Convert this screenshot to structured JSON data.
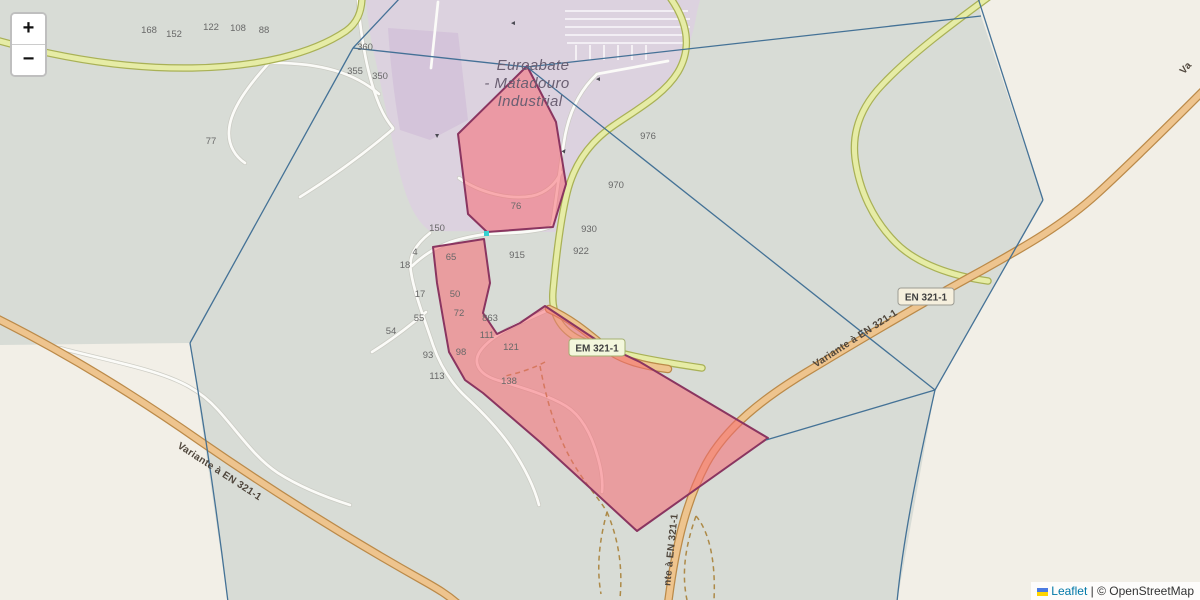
{
  "map": {
    "zoom_control": {
      "zoom_in": "+",
      "zoom_out": "−"
    },
    "attribution": {
      "leaflet": "Leaflet",
      "separator": " | ",
      "copyright": "© OpenStreetMap"
    },
    "place_label": {
      "lines": [
        "Euroabate",
        "- Matadouro",
        "Industrial"
      ]
    },
    "road_badges": [
      {
        "text": "EN 321-1",
        "x": 926,
        "y": 297,
        "style": "primary"
      },
      {
        "text": "EM 321-1",
        "x": 597,
        "y": 348,
        "style": "secondary"
      }
    ],
    "road_name_labels": [
      {
        "text": "Variante à EN 321-1",
        "x": 857,
        "y": 341,
        "rotate": -33
      },
      {
        "text": "Variante à EN 321-1",
        "x": 218,
        "y": 474,
        "rotate": 33
      },
      {
        "text": "nte à EN 321-1",
        "x": 674,
        "y": 550,
        "rotate": -84
      },
      {
        "text": "Va",
        "x": 1188,
        "y": 70,
        "rotate": -48
      }
    ],
    "house_numbers": [
      {
        "t": "168",
        "x": 149,
        "y": 33
      },
      {
        "t": "152",
        "x": 174,
        "y": 37
      },
      {
        "t": "122",
        "x": 211,
        "y": 30
      },
      {
        "t": "108",
        "x": 238,
        "y": 31
      },
      {
        "t": "88",
        "x": 264,
        "y": 33
      },
      {
        "t": "77",
        "x": 211,
        "y": 144
      },
      {
        "t": "360",
        "x": 365,
        "y": 50
      },
      {
        "t": "355",
        "x": 355,
        "y": 74
      },
      {
        "t": "350",
        "x": 380,
        "y": 79
      },
      {
        "t": "150",
        "x": 437,
        "y": 231
      },
      {
        "t": "4",
        "x": 415,
        "y": 255
      },
      {
        "t": "18",
        "x": 405,
        "y": 268
      },
      {
        "t": "65",
        "x": 451,
        "y": 260
      },
      {
        "t": "915",
        "x": 517,
        "y": 258
      },
      {
        "t": "17",
        "x": 420,
        "y": 297
      },
      {
        "t": "50",
        "x": 455,
        "y": 297
      },
      {
        "t": "72",
        "x": 459,
        "y": 316
      },
      {
        "t": "863",
        "x": 490,
        "y": 321
      },
      {
        "t": "55",
        "x": 419,
        "y": 321
      },
      {
        "t": "54",
        "x": 391,
        "y": 334
      },
      {
        "t": "93",
        "x": 428,
        "y": 358
      },
      {
        "t": "98",
        "x": 461,
        "y": 355
      },
      {
        "t": "113",
        "x": 437,
        "y": 379
      },
      {
        "t": "111",
        "x": 487,
        "y": 338
      },
      {
        "t": "121",
        "x": 511,
        "y": 350
      },
      {
        "t": "138",
        "x": 509,
        "y": 384
      },
      {
        "t": "76",
        "x": 516,
        "y": 209
      },
      {
        "t": "976",
        "x": 648,
        "y": 139
      },
      {
        "t": "970",
        "x": 616,
        "y": 188
      },
      {
        "t": "930",
        "x": 589,
        "y": 232
      },
      {
        "t": "922",
        "x": 581,
        "y": 254
      }
    ],
    "oneway_arrows": [
      {
        "x": 598,
        "y": 74,
        "r": 180
      },
      {
        "x": 566,
        "y": 149,
        "r": -55
      },
      {
        "x": 435,
        "y": 133,
        "r": 90
      },
      {
        "x": 513,
        "y": 18,
        "r": 180
      }
    ],
    "colors": {
      "background": "#f2efe7",
      "parcel_fill_tint": "#d9dedb",
      "parcel_outline": "#3c6b92",
      "selected_parcel_fill": "#f2696e",
      "selected_parcel_outline": "#8a3560",
      "primary_road": "#eec48e",
      "secondary_road": "#e6eca6",
      "industrial_area": "#dcd2df",
      "link": "#0078a8"
    }
  }
}
